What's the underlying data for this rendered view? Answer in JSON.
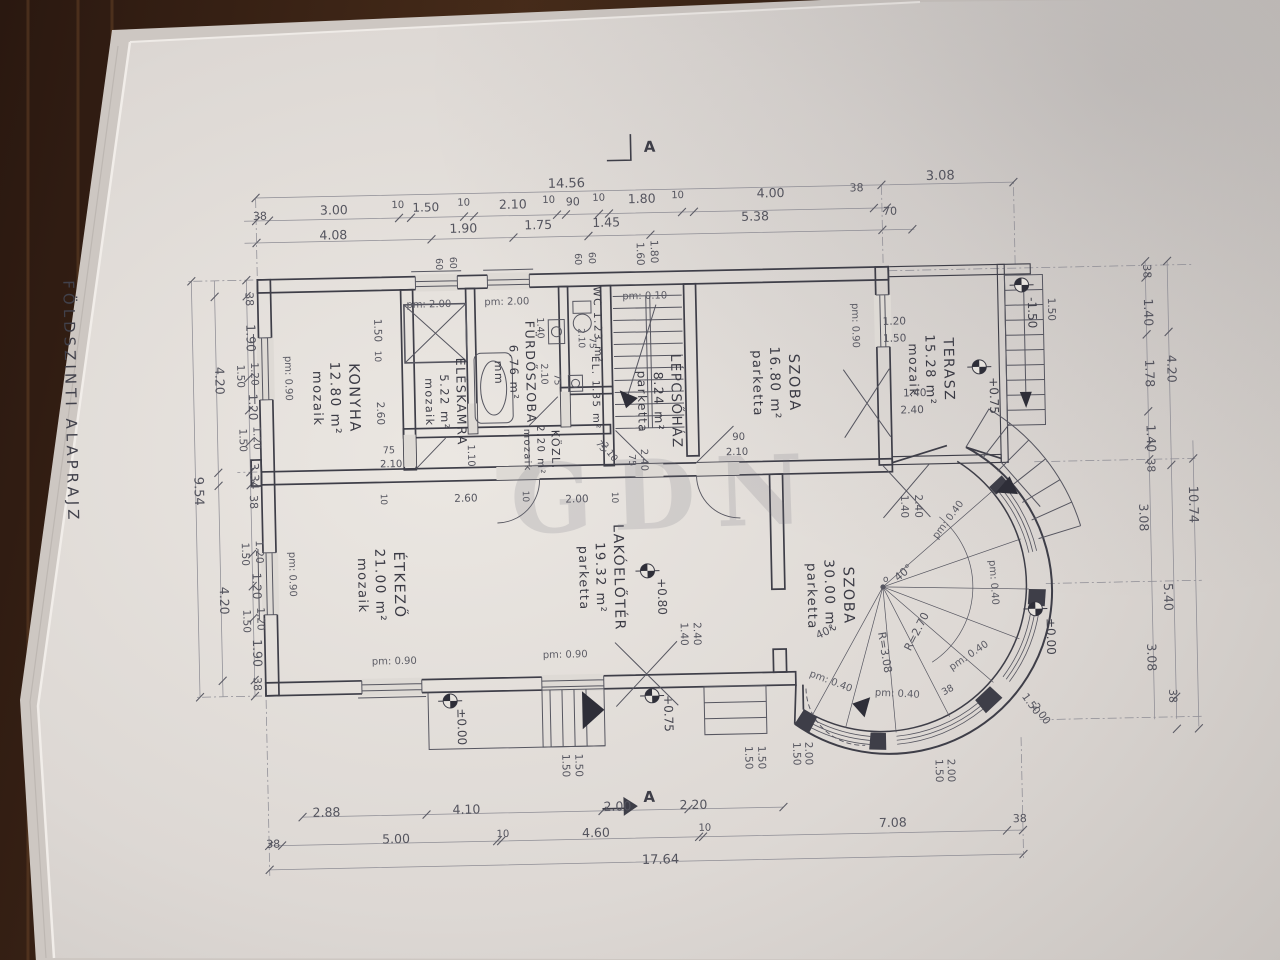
{
  "title": "FÖLDSZINTI ALAPRAJZ",
  "watermark": "GDN",
  "section_markers": {
    "top": "A",
    "bottom": "A"
  },
  "rooms": [
    {
      "name": "KONYHA",
      "area": "12.80 m²",
      "floor": "mozaik",
      "x": 352,
      "y": 392,
      "s": 14.5
    },
    {
      "name": "ÉLÉSKAMRA",
      "area": "5.22 m²",
      "floor": "mozaik",
      "x": 459,
      "y": 398,
      "s": 12.5
    },
    {
      "name": "FÜRDŐSZOBA",
      "area": "6.76 m²",
      "floor": "mm",
      "x": 529,
      "y": 370,
      "s": 12.5
    },
    {
      "name": "WC 1.23 m²",
      "area": "",
      "floor": "",
      "x": 598,
      "y": 324,
      "s": 10.5
    },
    {
      "name": "EL. 1.35 m²",
      "area": "",
      "floor": "",
      "x": 595,
      "y": 392,
      "s": 10
    },
    {
      "name": "KÖZL.",
      "area": "2.20 m²",
      "floor": "mozaik",
      "x": 553,
      "y": 448,
      "s": 11
    },
    {
      "name": "LÉPCSŐHÁZ",
      "area": "8.24 m²",
      "floor": "parketta",
      "x": 674,
      "y": 402,
      "s": 13.5
    },
    {
      "name": "SZOBA",
      "area": "16.80 m²",
      "floor": "parketta",
      "x": 792,
      "y": 386,
      "s": 14.5
    },
    {
      "name": "TERASZ",
      "area": "15.28 m²",
      "floor": "mozaik",
      "x": 947,
      "y": 376,
      "s": 14
    },
    {
      "name": "ÉTKEZŐ",
      "area": "21.00 m²",
      "floor": "mozaik",
      "x": 393,
      "y": 580,
      "s": 14.5
    },
    {
      "name": "LAKÓELŐTÉR",
      "area": "19.32 m²",
      "floor": "parketta",
      "x": 613,
      "y": 577,
      "s": 14
    },
    {
      "name": "SZOBA",
      "area": "30.00 m²",
      "floor": "parketta",
      "x": 842,
      "y": 600,
      "s": 14.5
    }
  ],
  "dimension_chains": {
    "top_overall": [
      [
        "14.56",
        573,
        186,
        0,
        13
      ],
      [
        "3.08",
        947,
        186,
        0,
        13
      ]
    ],
    "top_segments": [
      [
        "38",
        266,
        212,
        0,
        11
      ],
      [
        "3.00",
        340,
        208,
        0,
        12.5
      ],
      [
        "10",
        404,
        203,
        0,
        10
      ],
      [
        "1.50",
        432,
        207,
        0,
        12
      ],
      [
        "10",
        470,
        202,
        0,
        10
      ],
      [
        "2.10",
        519,
        206,
        0,
        12.5
      ],
      [
        "10",
        555,
        201,
        0,
        10
      ],
      [
        "90",
        579,
        204,
        0,
        11
      ],
      [
        "10",
        605,
        200,
        0,
        10
      ],
      [
        "1.80",
        648,
        203,
        0,
        12.5
      ],
      [
        "10",
        684,
        199,
        0,
        10
      ],
      [
        "4.00",
        777,
        200,
        0,
        12.5
      ],
      [
        "38",
        863,
        196,
        0,
        11
      ]
    ],
    "top_sub": [
      [
        "4.08",
        339,
        233,
        0,
        12.5
      ],
      [
        "1.90",
        469,
        229,
        0,
        12.5
      ],
      [
        "1.75",
        544,
        227,
        0,
        12.5
      ],
      [
        "1.45",
        612,
        226,
        0,
        12.5
      ],
      [
        "5.38",
        761,
        223,
        0,
        12.5
      ],
      [
        "70",
        896,
        220,
        0,
        11
      ]
    ],
    "bottom_spans": [
      [
        "2.88",
        320,
        810,
        0,
        12.5
      ],
      [
        "4.10",
        460,
        810,
        0,
        12.5
      ],
      [
        "2.00",
        611,
        810,
        0,
        12.5
      ],
      [
        "2.20",
        687,
        810,
        0,
        12.5
      ]
    ],
    "bottom_segments": [
      [
        "38",
        266,
        840,
        0,
        11
      ],
      [
        "5.00",
        389,
        838,
        0,
        12.5
      ],
      [
        "10",
        496,
        834,
        0,
        10
      ],
      [
        "4.60",
        589,
        836,
        0,
        12.5
      ],
      [
        "10",
        698,
        832,
        0,
        10
      ],
      [
        "7.08",
        886,
        832,
        0,
        12.5
      ],
      [
        "38",
        1013,
        830,
        0,
        11
      ]
    ],
    "bottom_overall": [
      [
        "17.64",
        653,
        864,
        0,
        13
      ]
    ],
    "left": [
      [
        "38",
        250,
        291,
        90,
        11
      ],
      [
        "1.90",
        250,
        330,
        90,
        12.5
      ],
      [
        "1.20",
        254,
        366,
        90,
        10.5
      ],
      [
        "1.50",
        240,
        368,
        90,
        10.5
      ],
      [
        "1.20",
        251,
        399,
        90,
        12
      ],
      [
        "1.20",
        255,
        430,
        90,
        10.5
      ],
      [
        "1.50",
        241,
        432,
        90,
        10.5
      ],
      [
        "3.34",
        251,
        468,
        90,
        12
      ],
      [
        "38",
        250,
        494,
        90,
        11
      ],
      [
        "1.20",
        255,
        544,
        90,
        10.5
      ],
      [
        "1.50",
        241,
        546,
        90,
        10.5
      ],
      [
        "1.20",
        251,
        578,
        90,
        12
      ],
      [
        "1.20",
        255,
        611,
        90,
        10.5
      ],
      [
        "1.50",
        241,
        613,
        90,
        10.5
      ],
      [
        "1.90",
        250,
        645,
        90,
        12.5
      ],
      [
        "38",
        250,
        676,
        90,
        11
      ],
      [
        "4.20",
        218,
        372,
        90,
        12.5
      ],
      [
        "4.20",
        218,
        592,
        90,
        12.5
      ],
      [
        "9.54",
        195,
        482,
        90,
        13
      ]
    ],
    "right": [
      [
        "38",
        1148,
        282,
        90,
        11
      ],
      [
        "1.40",
        1148,
        323,
        90,
        12.5
      ],
      [
        "1.78",
        1148,
        384,
        90,
        12.5
      ],
      [
        "1.40",
        1148,
        449,
        90,
        12.5
      ],
      [
        "38",
        1148,
        476,
        90,
        11
      ],
      [
        "4.20",
        1170,
        380,
        90,
        12.5
      ],
      [
        "3.08",
        1139,
        528,
        90,
        12.5
      ],
      [
        "5.40",
        1162,
        608,
        90,
        12.5
      ],
      [
        "3.08",
        1144,
        668,
        90,
        12.5
      ],
      [
        "38",
        1165,
        707,
        90,
        11
      ],
      [
        "10.74",
        1189,
        516,
        90,
        13
      ]
    ]
  },
  "annotations": [
    [
      "pm: 2.00",
      433,
      303,
      0,
      10,
      "pm"
    ],
    [
      "pm: 2.00",
      511,
      302,
      0,
      10,
      "pm"
    ],
    [
      "pm: 0.10",
      649,
      299,
      0,
      10,
      "pm"
    ],
    [
      "pm: 0.90",
      288,
      371,
      90,
      10,
      "pm"
    ],
    [
      "pm: 0.90",
      288,
      567,
      90,
      10,
      "pm"
    ],
    [
      "pm: 0.90",
      856,
      330,
      90,
      10,
      "pm"
    ],
    [
      "pm: 0.90",
      391,
      659,
      0,
      10,
      "pm"
    ],
    [
      "pm: 0.90",
      562,
      656,
      0,
      10,
      "pm"
    ],
    [
      "pm: 0.40",
      950,
      528,
      -52,
      10,
      "pm"
    ],
    [
      "pm: 0.40",
      989,
      590,
      87,
      10,
      "pm"
    ],
    [
      "pm: 0.40",
      967,
      665,
      -33,
      10,
      "pm"
    ],
    [
      "pm: 0.40",
      893,
      702,
      4,
      10,
      "pm"
    ],
    [
      "pm: 0.40",
      826,
      688,
      22,
      10,
      "pm"
    ],
    [
      "+0.75",
      992,
      403,
      90,
      12,
      "elev"
    ],
    [
      "+0.80",
      656,
      597,
      90,
      12,
      "elev"
    ],
    [
      "±0.00",
      453,
      723,
      90,
      12,
      "elev"
    ],
    [
      "+0.75",
      660,
      714,
      90,
      12,
      "elev"
    ],
    [
      "±0.00",
      1044,
      645,
      90,
      12,
      "elev"
    ],
    [
      "-1.50",
      1032,
      321,
      90,
      12,
      "elev"
    ],
    [
      "R=2.70",
      917,
      639,
      -62,
      11,
      "dim"
    ],
    [
      "R=3.08",
      878,
      658,
      82,
      11,
      "dim"
    ],
    [
      "40°",
      904,
      581,
      -38,
      11,
      "dim"
    ],
    [
      "40°",
      824,
      639,
      -24,
      11,
      "dim"
    ],
    [
      "o",
      884,
      587,
      0,
      9,
      "dim"
    ],
    [
      "60",
      580,
      258,
      90,
      9.5,
      "dim"
    ],
    [
      "60",
      594,
      257,
      90,
      9.5,
      "dim"
    ],
    [
      "60",
      441,
      260,
      90,
      9.5,
      "dim"
    ],
    [
      "60",
      455,
      259,
      90,
      9.5,
      "dim"
    ],
    [
      "1.60",
      642,
      254,
      90,
      10.5,
      "dim"
    ],
    [
      "1.80",
      656,
      252,
      90,
      10.5,
      "dim"
    ],
    [
      "1.50",
      378,
      325,
      90,
      10.5,
      "dim"
    ],
    [
      "10",
      378,
      351,
      90,
      9,
      "dim"
    ],
    [
      "2.60",
      379,
      408,
      90,
      10.5,
      "dim"
    ],
    [
      "75",
      390,
      448,
      0,
      9.5,
      "dim"
    ],
    [
      "2.10",
      392,
      462,
      0,
      10,
      "dim"
    ],
    [
      "10",
      381,
      494,
      90,
      9,
      "dim"
    ],
    [
      "2.60",
      466,
      498,
      0,
      10.5,
      "dim"
    ],
    [
      "10",
      523,
      494,
      90,
      9,
      "dim"
    ],
    [
      "2.00",
      577,
      501,
      0,
      10.5,
      "dim"
    ],
    [
      "10",
      612,
      497,
      90,
      9,
      "dim"
    ],
    [
      "90",
      740,
      442,
      0,
      10,
      "dim"
    ],
    [
      "2.10",
      738,
      457,
      0,
      10,
      "dim"
    ],
    [
      "75",
      630,
      460,
      90,
      9.5,
      "dim"
    ],
    [
      "2.40",
      642,
      460,
      90,
      10,
      "dim"
    ],
    [
      "75",
      600,
      447,
      55,
      9,
      "dim"
    ],
    [
      "2.10",
      608,
      453,
      55,
      9.5,
      "dim"
    ],
    [
      "1.40",
      541,
      326,
      90,
      9.5,
      "dim"
    ],
    [
      "2.10",
      544,
      372,
      90,
      9.5,
      "dim"
    ],
    [
      "75",
      557,
      378,
      90,
      9,
      "dim"
    ],
    [
      "2.10",
      582,
      337,
      90,
      9,
      "dim"
    ],
    [
      "75",
      593,
      342,
      90,
      9,
      "dim"
    ],
    [
      "1.10",
      469,
      452,
      90,
      10,
      "dim"
    ],
    [
      "1.20",
      898,
      330,
      0,
      10.5,
      "dim"
    ],
    [
      "1.50",
      898,
      347,
      0,
      10.5,
      "dim"
    ],
    [
      "1.40",
      917,
      402,
      0,
      10.5,
      "dim"
    ],
    [
      "2.40",
      914,
      419,
      0,
      10.5,
      "dim"
    ],
    [
      "1.40",
      901,
      512,
      90,
      10.5,
      "dim"
    ],
    [
      "2.40",
      915,
      512,
      90,
      10.5,
      "dim"
    ],
    [
      "1.40",
      678,
      635,
      90,
      10.5,
      "dim"
    ],
    [
      "2.40",
      691,
      635,
      90,
      10.5,
      "dim"
    ],
    [
      "1.50",
      557,
      764,
      90,
      10.5,
      "dim"
    ],
    [
      "1.50",
      570,
      764,
      90,
      10.5,
      "dim"
    ],
    [
      "1.50",
      740,
      760,
      90,
      10.5,
      "dim"
    ],
    [
      "1.50",
      753,
      760,
      90,
      10.5,
      "dim"
    ],
    [
      "1.50",
      788,
      757,
      90,
      10.5,
      "dim"
    ],
    [
      "2.00",
      800,
      757,
      90,
      10.5,
      "dim"
    ],
    [
      "1.50",
      930,
      777,
      90,
      10.5,
      "dim"
    ],
    [
      "2.00",
      942,
      777,
      90,
      10.5,
      "dim"
    ],
    [
      "1.50",
      1024,
      714,
      55,
      10.5,
      "dim"
    ],
    [
      "2.00",
      1034,
      724,
      55,
      10.5,
      "dim"
    ],
    [
      "38",
      945,
      699,
      -28,
      9.5,
      "dim"
    ],
    [
      "1.50",
      1052,
      318,
      90,
      10.5,
      "dim"
    ]
  ]
}
